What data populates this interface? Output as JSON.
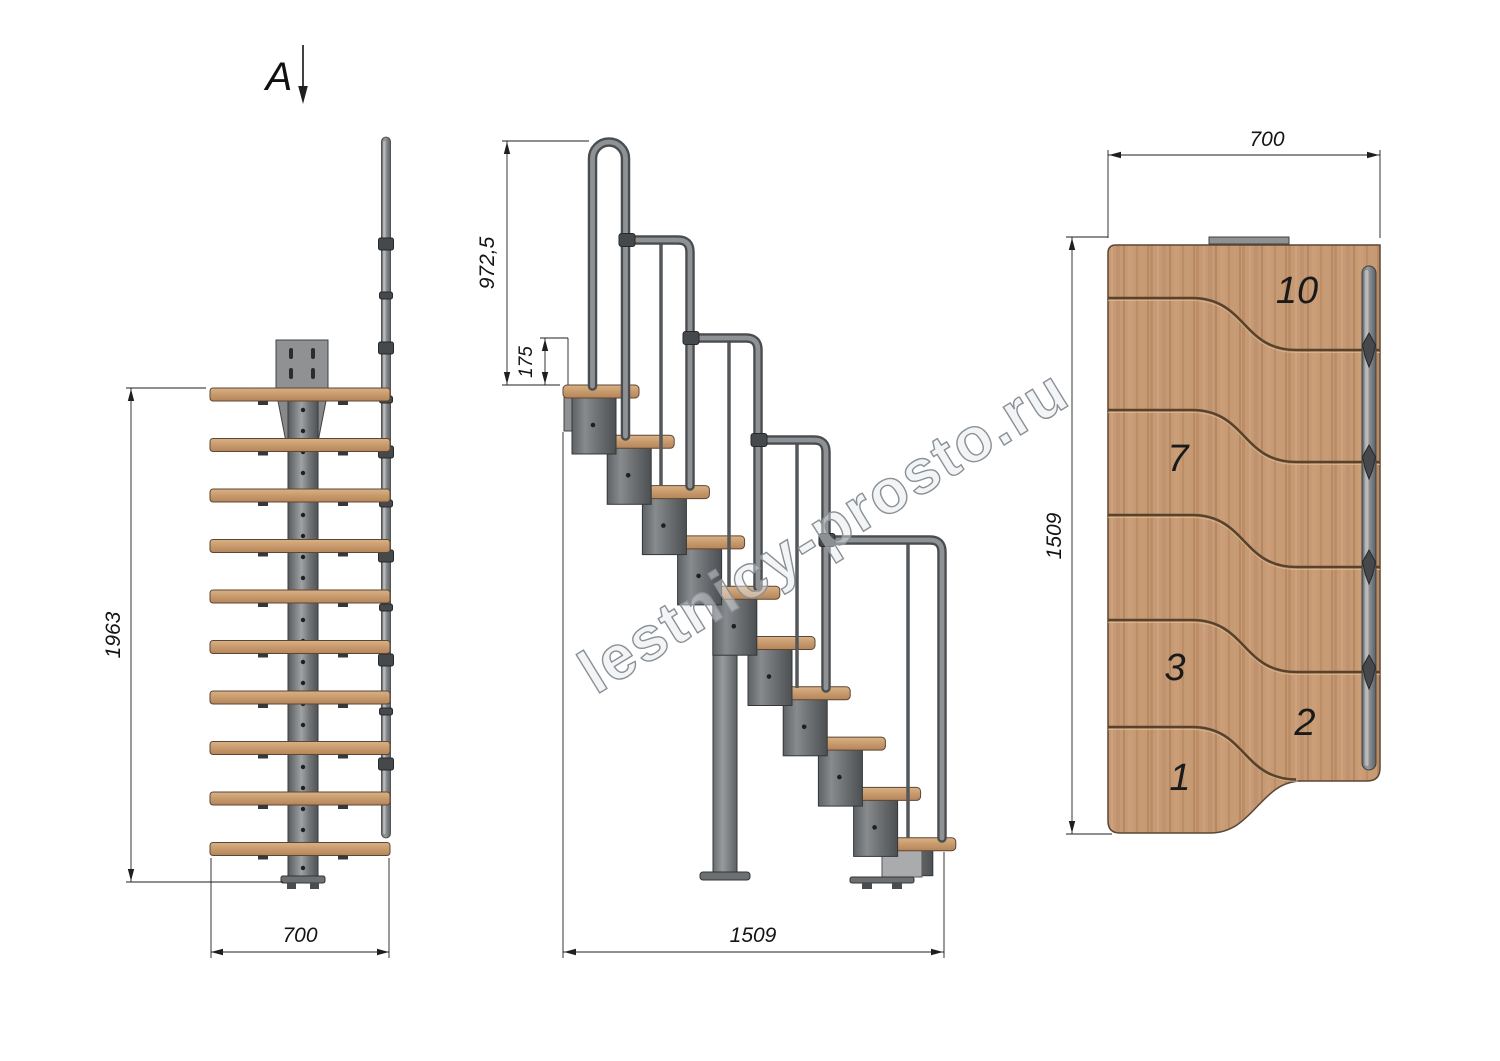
{
  "section_label": "A",
  "watermark": "lestnicy-prosto.ru",
  "front_view": {
    "height_dim": "1963",
    "width_dim": "700"
  },
  "side_view": {
    "rail_height_dim": "972,5",
    "rise_dim": "175",
    "length_dim": "1509"
  },
  "plan_view": {
    "width_dim": "700",
    "length_dim": "1509",
    "step_numbers": {
      "s10": "10",
      "s7": "7",
      "s3": "3",
      "s2": "2",
      "s1": "1"
    }
  },
  "colors": {
    "wood": "#c69a74",
    "wood_edge": "#5d4633",
    "metal": "#7a7d80",
    "metal_dark": "#34373a",
    "line": "#1f1f1f",
    "watermark_gray": "#899096"
  }
}
